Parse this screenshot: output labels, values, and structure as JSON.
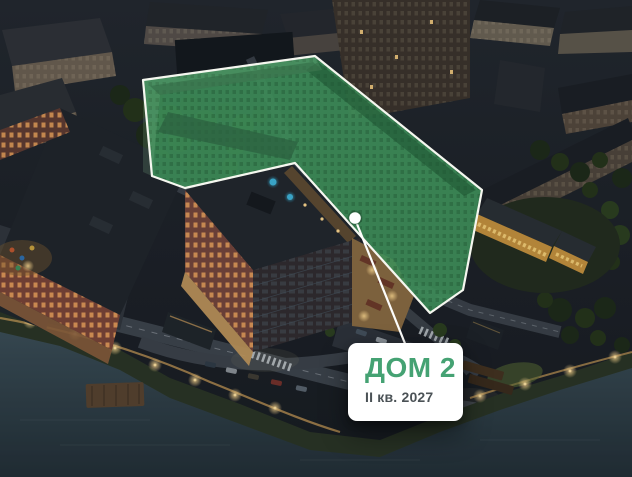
{
  "callout": {
    "title": "ДОМ 2",
    "subtitle": "II кв. 2027",
    "colors": {
      "title": "#45a273",
      "subtitle": "#4b5256",
      "background": "#ffffff"
    }
  },
  "highlight": {
    "fill": "#3e8e59",
    "outline": "#f5f7ef",
    "marker_icon": "white-dot-marker"
  }
}
